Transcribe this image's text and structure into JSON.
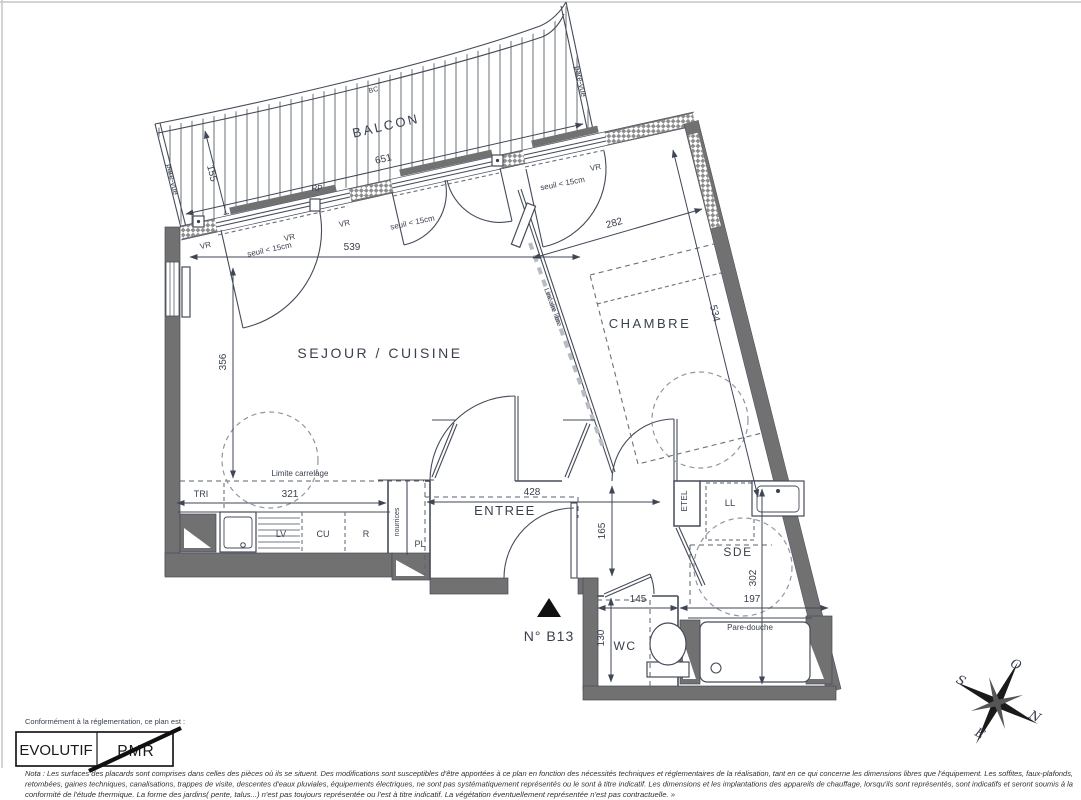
{
  "plan": {
    "rooms": {
      "balcon": "BALCON",
      "sejour": "SEJOUR / CUISINE",
      "chambre": "CHAMBRE",
      "entree": "ENTREE",
      "sde": "SDE",
      "wc": "WC"
    },
    "unit": {
      "number": "N° B13"
    },
    "dimensions": {
      "balcon_length": "651",
      "balcon_width": "155",
      "sejour_width": "539",
      "sejour_depth": "356",
      "kitchen_width": "321",
      "chambre_width": "282",
      "chambre_length": "534",
      "entree_width": "428",
      "entree_depth": "165",
      "sde_depth": "302",
      "sde_width": "197",
      "wc_width": "145",
      "wc_depth": "130"
    },
    "annotations": {
      "pare_vue": "pare-vue",
      "bc": "BC",
      "rp": "RP",
      "vr": "VR",
      "seuil": "seuil < 15cm",
      "lineaire_libre": "Linéaire libre",
      "limite_carrelage": "Limite carrelage",
      "tri": "TRI",
      "lv": "LV",
      "cu": "CU",
      "r": "R",
      "pl": "PL",
      "nourrices": "nourrices",
      "etel": "ETEL",
      "ll": "LL",
      "pare_douche": "Pare-douche"
    },
    "compass": {
      "n": "N",
      "s": "S",
      "e": "E",
      "o": "O"
    },
    "legend": {
      "intro": "Conformément à la réglementation, ce plan est :",
      "evolutif": "EVOLUTIF",
      "pmr": "PMR"
    },
    "nota": {
      "line1": "Nota : Les surfaces des placards sont comprises dans celles des pièces où ils se situent. Des modifications sont susceptibles d'être apportées à ce plan en fonction des nécessités techniques et réglementaires de la réalisation, tant en ce qui concerne les dimensions libres que l'équipement.  Les soffites, faux-plafonds,",
      "line2": "retombées, gaines techniques, canalisations, trappes de visite, descentes d'eaux pluviales, équipements électriques, ne sont pas systématiquement représentés ou le sont à titre indicatif. Les dimensions et les implantations des appareils de chauffage, lorsqu'ils sont représentés, sont indicatifs et seront soumis à la",
      "line3": "conformité de l'étude thermique. La forme des jardins( pente, talus...) n'est pas toujours représentée ou l'est à titre indicatif. La végétation éventuellement représentée n'est pas contractuelle. »"
    }
  }
}
